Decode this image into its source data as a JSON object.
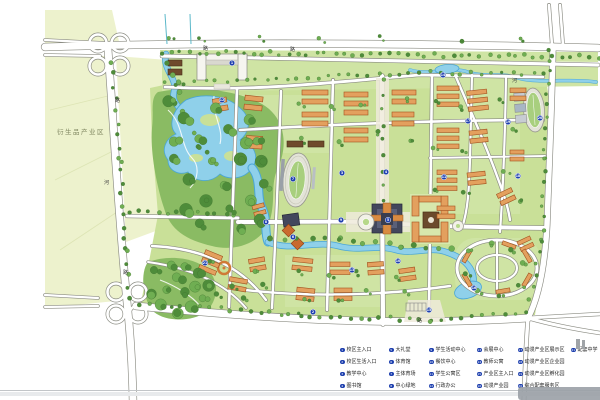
{
  "page": {
    "background": "#ffffff"
  },
  "map": {
    "marker_color": "#1d3fae",
    "palette": {
      "field": "#edf2cd",
      "lawn": "#c9e098",
      "tree_dark": "#4e8c3a",
      "tree_mid": "#6fae52",
      "water": "#8fd0ea",
      "water_deep": "#4aa6d6",
      "road_fill": "#ffffff",
      "road_stroke": "#8a8b82",
      "building": "#e3a05e",
      "building_stroke": "#a2511e",
      "roof_dark": "#42475c",
      "roof_brown": "#6f4a2c",
      "landmark": "#f6f5ef",
      "marker": "#1d3fae"
    },
    "labels": [
      {
        "text": "衍生品产业区",
        "x": 57,
        "y": 134
      }
    ],
    "glyphs": [
      {
        "text": "路",
        "x": 203,
        "y": 50
      },
      {
        "text": "路",
        "x": 290,
        "y": 51
      },
      {
        "text": "路",
        "x": 115,
        "y": 102
      },
      {
        "text": "河",
        "x": 104,
        "y": 184
      },
      {
        "text": "路",
        "x": 123,
        "y": 274
      },
      {
        "text": "路",
        "x": 417,
        "y": 322
      },
      {
        "text": "河",
        "x": 512,
        "y": 82
      }
    ],
    "markers": [
      {
        "n": 1,
        "x": 232,
        "y": 63
      },
      {
        "n": 2,
        "x": 313,
        "y": 312
      },
      {
        "n": 3,
        "x": 342,
        "y": 173
      },
      {
        "n": 4,
        "x": 386,
        "y": 172
      },
      {
        "n": 5,
        "x": 388,
        "y": 220
      },
      {
        "n": 6,
        "x": 293,
        "y": 237
      },
      {
        "n": 7,
        "x": 293,
        "y": 179
      },
      {
        "n": 8,
        "x": 266,
        "y": 222
      },
      {
        "n": 9,
        "x": 341,
        "y": 220
      },
      {
        "n": 10,
        "x": 398,
        "y": 261
      },
      {
        "n": 11,
        "x": 444,
        "y": 177
      },
      {
        "n": 12,
        "x": 222,
        "y": 100
      },
      {
        "n": 13,
        "x": 352,
        "y": 270
      },
      {
        "n": 14,
        "x": 443,
        "y": 75
      },
      {
        "n": 15,
        "x": 429,
        "y": 310
      },
      {
        "n": 16,
        "x": 474,
        "y": 288
      },
      {
        "n": 17,
        "x": 468,
        "y": 121
      },
      {
        "n": 18,
        "x": 518,
        "y": 176
      },
      {
        "n": 19,
        "x": 508,
        "y": 122
      },
      {
        "n": 20,
        "x": 540,
        "y": 118
      },
      {
        "n": 21,
        "x": 205,
        "y": 263
      }
    ]
  },
  "legend": {
    "dot_color": "#1d3fae",
    "columns": [
      {
        "items": [
          {
            "n": 1,
            "label": "校区主入口"
          },
          {
            "n": 2,
            "label": "校区生活入口"
          },
          {
            "n": 3,
            "label": "教学中心"
          },
          {
            "n": 4,
            "label": "图书馆"
          }
        ]
      },
      {
        "items": [
          {
            "n": 5,
            "label": "大礼堂"
          },
          {
            "n": 6,
            "label": "体育馆"
          },
          {
            "n": 7,
            "label": "主体育场"
          },
          {
            "n": 8,
            "label": "中心绿地"
          }
        ]
      },
      {
        "items": [
          {
            "n": 9,
            "label": "学生活动中心"
          },
          {
            "n": 10,
            "label": "餐饮中心"
          },
          {
            "n": 11,
            "label": "学生公寓区"
          },
          {
            "n": 12,
            "label": "行政办公"
          }
        ]
      },
      {
        "items": [
          {
            "n": 13,
            "label": "会展中心"
          },
          {
            "n": 14,
            "label": "教师公寓"
          },
          {
            "n": 15,
            "label": "产业区主入口"
          },
          {
            "n": 16,
            "label": "动漫产业园"
          }
        ]
      },
      {
        "items": [
          {
            "n": 17,
            "label": "动漫产业区展示区"
          },
          {
            "n": 18,
            "label": "动漫产业区企业园"
          },
          {
            "n": 19,
            "label": "动漫产业区孵化园"
          },
          {
            "n": 20,
            "label": "综合配套服务区"
          }
        ]
      },
      {
        "items": [
          {
            "n": 21,
            "label": "配套中学"
          }
        ]
      }
    ]
  }
}
